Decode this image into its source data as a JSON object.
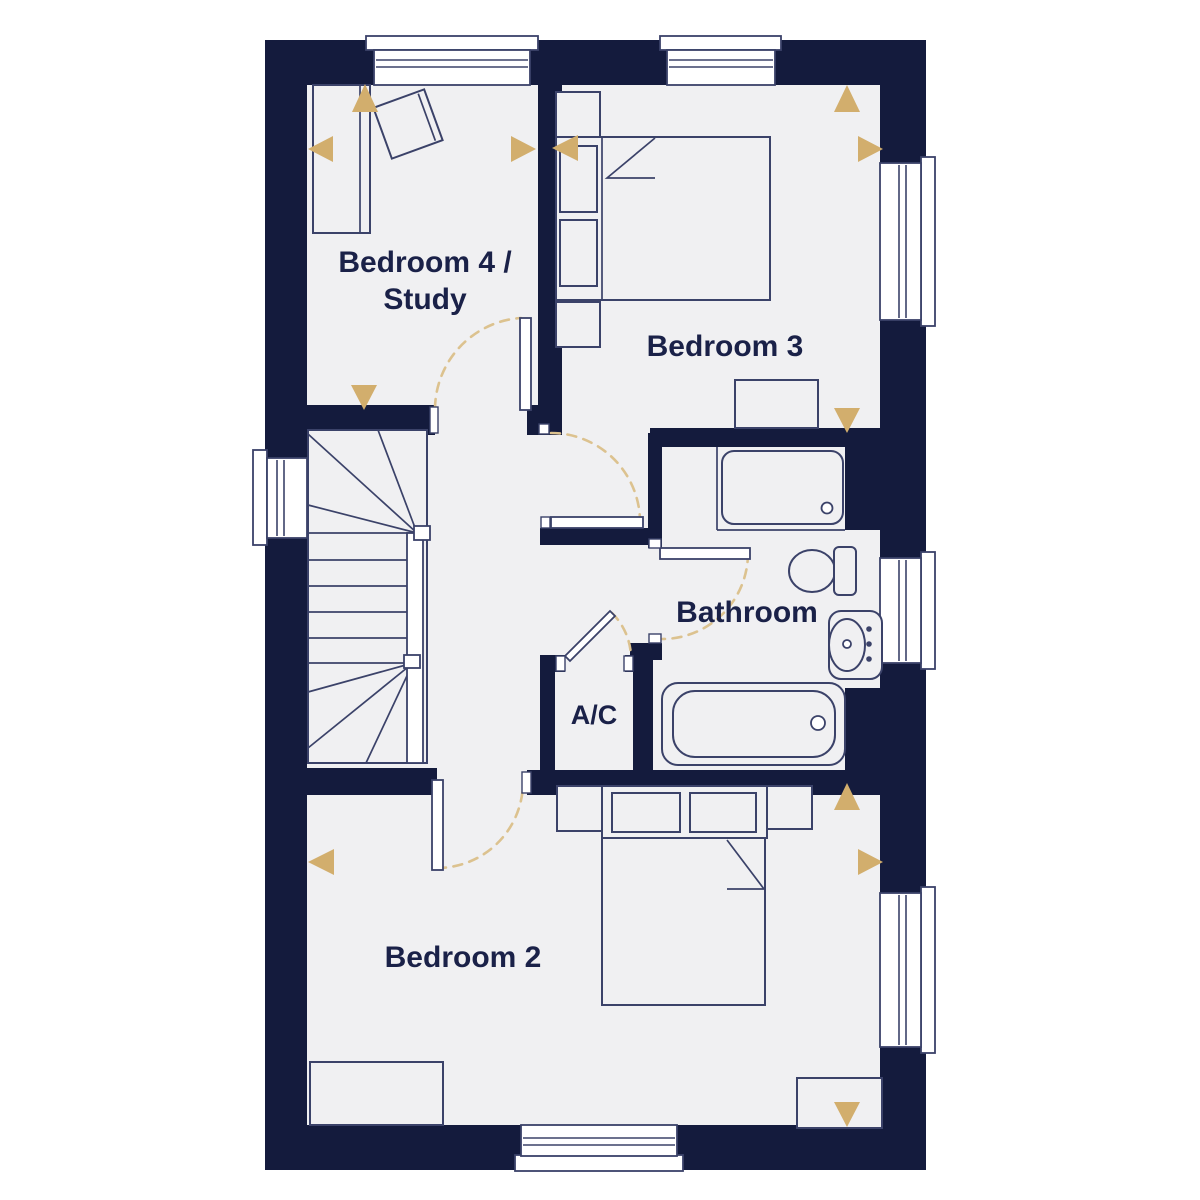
{
  "colors": {
    "wall": "#141b3d",
    "floor": "#f0f0f2",
    "line": "#3b4269",
    "accent_gold": "#d2ae6d",
    "door_arc_gold": "#dcc28f",
    "label_text": "#1a2148",
    "background": "#ffffff"
  },
  "plan": {
    "floor_name": "",
    "rooms": [
      {
        "id": "bedroom4_study",
        "label_line1": "Bedroom 4 /",
        "label_line2": "Study",
        "furniture": [
          "desk",
          "desk-chair"
        ],
        "direction_markers": [
          "up",
          "left",
          "right",
          "down"
        ]
      },
      {
        "id": "bedroom3",
        "label": "Bedroom 3",
        "furniture": [
          "double-bed",
          "bedside-table",
          "bedside-table",
          "chest-of-drawers"
        ],
        "direction_markers": [
          "up",
          "left",
          "right",
          "down"
        ]
      },
      {
        "id": "bathroom",
        "label": "Bathroom",
        "furniture": [
          "shower-tray",
          "toilet",
          "pedestal-basin",
          "bath"
        ],
        "direction_markers": []
      },
      {
        "id": "airing_cupboard",
        "label": "A/C",
        "furniture": [],
        "direction_markers": []
      },
      {
        "id": "bedroom2",
        "label": "Bedroom 2",
        "furniture": [
          "double-bed",
          "bedside-table",
          "bedside-table",
          "chest-of-drawers",
          "chest-of-drawers"
        ],
        "direction_markers": [
          "up",
          "left",
          "right",
          "down"
        ]
      },
      {
        "id": "landing",
        "label": "",
        "furniture": [
          "staircase"
        ],
        "direction_markers": []
      }
    ],
    "window_count": 7,
    "door_count": 5
  }
}
